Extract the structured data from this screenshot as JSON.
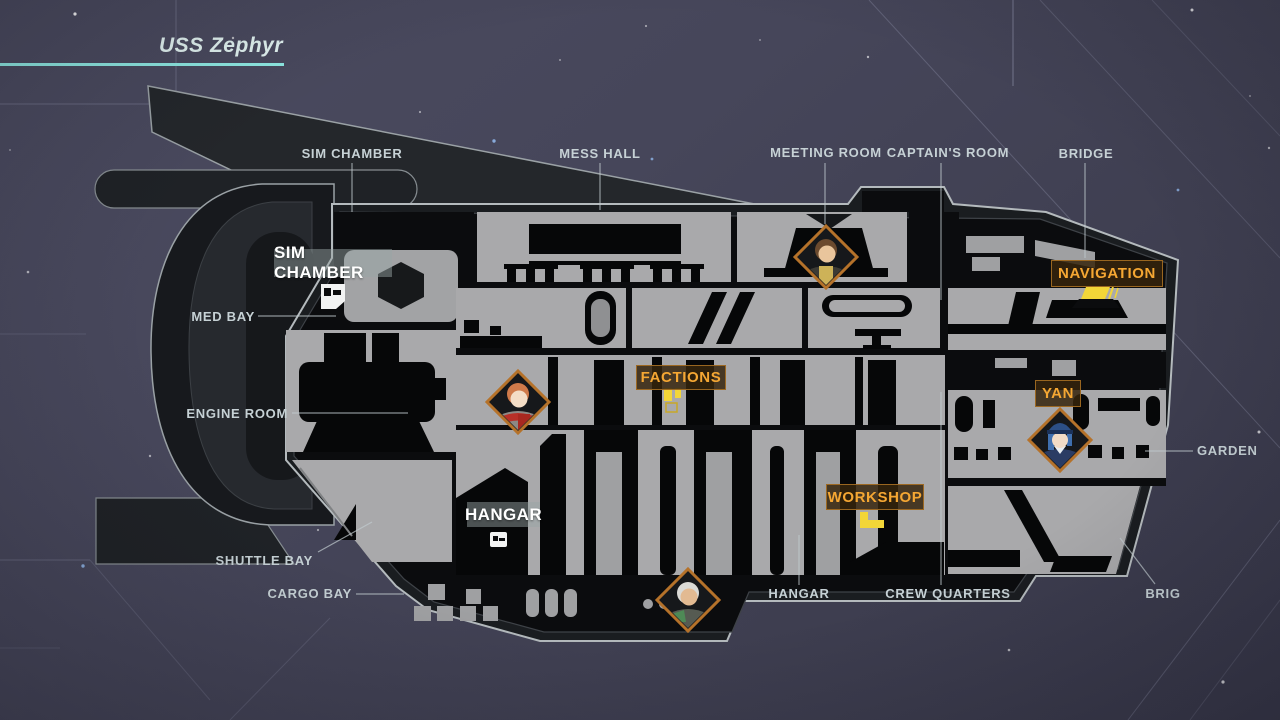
{
  "ship": {
    "name": "USS Zephyr"
  },
  "callouts": {
    "sim_chamber": "SIM CHAMBER",
    "mess_hall": "MESS HALL",
    "meeting_room": "MEETING ROOM",
    "captains_room": "CAPTAIN'S ROOM",
    "bridge": "BRIDGE",
    "med_bay": "MED BAY",
    "engine_room": "ENGINE ROOM",
    "shuttle_bay": "SHUTTLE BAY",
    "cargo_bay": "CARGO BAY",
    "hangar": "HANGAR",
    "crew_quarters": "CREW QUARTERS",
    "brig": "BRIG",
    "garden": "GARDEN"
  },
  "room_tags": {
    "sim_chamber": "SIM CHAMBER",
    "hangar": "HANGAR"
  },
  "poi_tags": {
    "factions": "FACTIONS",
    "workshop": "WORKSHOP",
    "navigation": "NAVIGATION",
    "yan": "YAN"
  },
  "characters": {
    "meeting_room": "portrait-brown-hair-man-icon",
    "quarters": "portrait-red-hair-person-icon",
    "navigation": "portrait-blue-hair-woman-yan-icon",
    "cargo": "portrait-white-hair-man-icon"
  },
  "colors": {
    "background": "#45455a",
    "hull_dark": "#1a1d20",
    "room_gray": "#a9a9ab",
    "accent_orange": "#f5a733",
    "icon_yellow": "#f2d638",
    "title_cyan": "#8ee9e3",
    "callout_text": "#c6d1d5",
    "diamond_border": "#b5722a"
  }
}
